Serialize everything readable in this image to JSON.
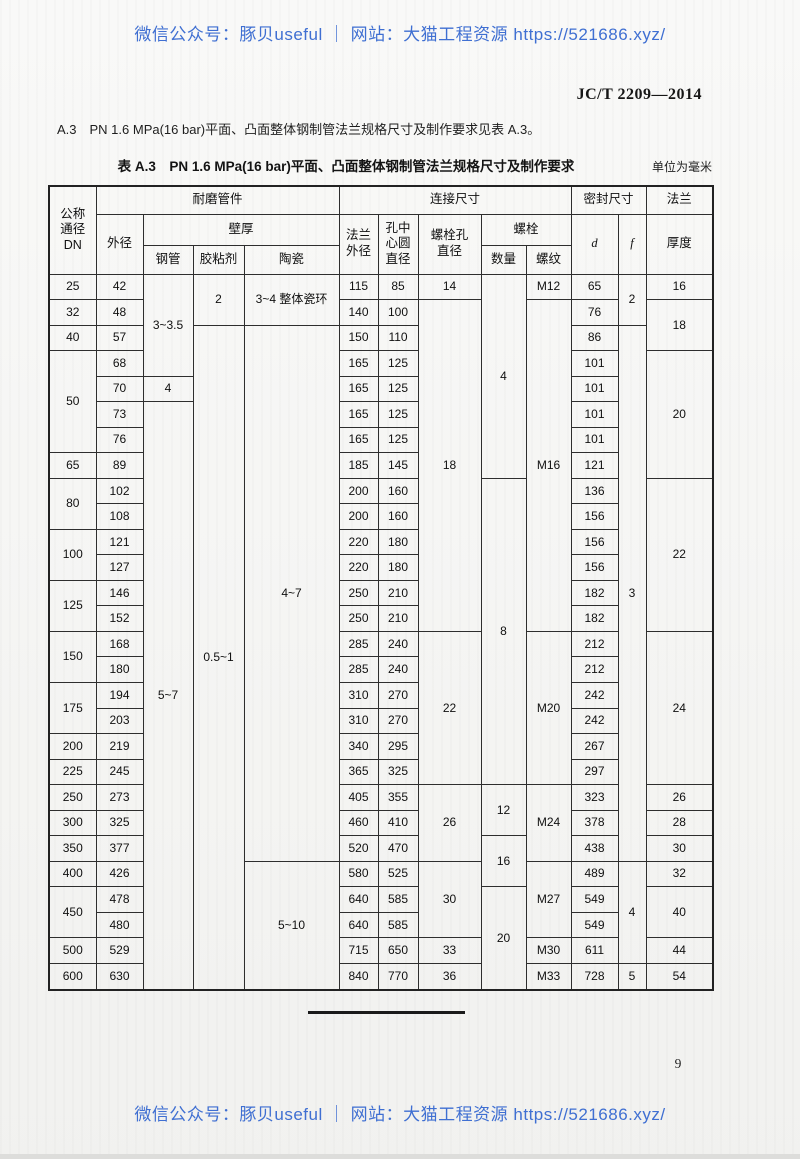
{
  "page": {
    "watermark_top": "微信公众号：豚贝useful ｜ 网站：大猫工程资源 https://521686.xyz/",
    "watermark_bottom": "微信公众号：豚贝useful ｜ 网站：大猫工程资源 https://521686.xyz/",
    "watermark_color": "#3f6fd2",
    "standard_code": "JC/T 2209—2014",
    "paragraph": "A.3　PN 1.6 MPa(16 bar)平面、凸面整体钢制管法兰规格尺寸及制作要求见表 A.3。",
    "page_number": "9"
  },
  "table": {
    "caption": "表 A.3　PN 1.6 MPa(16 bar)平面、凸面整体钢制管法兰规格尺寸及制作要求",
    "unit_note": "单位为毫米",
    "col_widths": [
      47,
      47,
      50,
      51,
      95,
      39,
      40,
      63,
      45,
      45,
      47,
      28,
      67
    ],
    "head_rows": [
      [
        {
          "t": "公称\n通径\nDN",
          "rs": 3
        },
        {
          "t": "耐磨管件",
          "cs": 4
        },
        {
          "t": "连接尺寸",
          "cs": 5
        },
        {
          "t": "密封尺寸",
          "cs": 2
        },
        {
          "t": "法兰"
        }
      ],
      [
        {
          "t": "外径",
          "rs": 2
        },
        {
          "t": "壁厚",
          "cs": 3
        },
        {
          "t": "法兰\n外径",
          "rs": 2
        },
        {
          "t": "孔中\n心圆\n直径",
          "rs": 2
        },
        {
          "t": "螺栓孔\n直径",
          "rs": 2
        },
        {
          "t": "螺栓",
          "cs": 2
        },
        {
          "t": "d",
          "rs": 2,
          "i": true
        },
        {
          "t": "f",
          "rs": 2,
          "i": true
        },
        {
          "t": "厚度",
          "rs": 2
        }
      ],
      [
        {
          "t": "钢管"
        },
        {
          "t": "胶粘剂"
        },
        {
          "t": "陶瓷"
        },
        {
          "t": "数量"
        },
        {
          "t": "螺纹"
        }
      ]
    ],
    "body_rows": [
      [
        {
          "t": "25"
        },
        {
          "t": "42"
        },
        {
          "t": "3~3.5",
          "rs": 4
        },
        {
          "t": "2",
          "rs": 2
        },
        {
          "t": "3~4 整体瓷环",
          "rs": 2
        },
        {
          "t": "115"
        },
        {
          "t": "85"
        },
        {
          "t": "14"
        },
        {
          "t": "4",
          "rs": 8
        },
        {
          "t": "M12"
        },
        {
          "t": "65"
        },
        {
          "t": "2",
          "rs": 2
        },
        {
          "t": "16"
        }
      ],
      [
        {
          "t": "32"
        },
        {
          "t": "48"
        },
        {
          "t": "140"
        },
        {
          "t": "100"
        },
        {
          "t": "18",
          "rs": 13
        },
        {
          "t": "M16",
          "rs": 13
        },
        {
          "t": "76"
        },
        {
          "t": "18",
          "rs": 2
        }
      ],
      [
        {
          "t": "40"
        },
        {
          "t": "57"
        },
        {
          "t": "0.5~1",
          "rs": 26
        },
        {
          "t": "4~7",
          "rs": 21
        },
        {
          "t": "150"
        },
        {
          "t": "110"
        },
        {
          "t": "86"
        },
        {
          "t": "3",
          "rs": 21
        }
      ],
      [
        {
          "t": "50",
          "rs": 4
        },
        {
          "t": "68"
        },
        {
          "t": "165"
        },
        {
          "t": "125"
        },
        {
          "t": "101"
        },
        {
          "t": "20",
          "rs": 5
        }
      ],
      [
        {
          "t": "70"
        },
        {
          "t": "4"
        },
        {
          "t": "165"
        },
        {
          "t": "125"
        },
        {
          "t": "101"
        }
      ],
      [
        {
          "t": "73"
        },
        {
          "t": "5~7",
          "rs": 23
        },
        {
          "t": "165"
        },
        {
          "t": "125"
        },
        {
          "t": "101"
        }
      ],
      [
        {
          "t": "76"
        },
        {
          "t": "165"
        },
        {
          "t": "125"
        },
        {
          "t": "101"
        }
      ],
      [
        {
          "t": "65"
        },
        {
          "t": "89"
        },
        {
          "t": "185"
        },
        {
          "t": "145"
        },
        {
          "t": "121"
        }
      ],
      [
        {
          "t": "80",
          "rs": 2
        },
        {
          "t": "102"
        },
        {
          "t": "200"
        },
        {
          "t": "160"
        },
        {
          "t": "8",
          "rs": 12
        },
        {
          "t": "136"
        },
        {
          "t": "22",
          "rs": 6
        }
      ],
      [
        {
          "t": "108"
        },
        {
          "t": "200"
        },
        {
          "t": "160"
        },
        {
          "t": "156"
        }
      ],
      [
        {
          "t": "100",
          "rs": 2
        },
        {
          "t": "121"
        },
        {
          "t": "220"
        },
        {
          "t": "180"
        },
        {
          "t": "156"
        }
      ],
      [
        {
          "t": "127"
        },
        {
          "t": "220"
        },
        {
          "t": "180"
        },
        {
          "t": "156"
        }
      ],
      [
        {
          "t": "125",
          "rs": 2
        },
        {
          "t": "146"
        },
        {
          "t": "250"
        },
        {
          "t": "210"
        },
        {
          "t": "182"
        }
      ],
      [
        {
          "t": "152"
        },
        {
          "t": "250"
        },
        {
          "t": "210"
        },
        {
          "t": "182"
        }
      ],
      [
        {
          "t": "150",
          "rs": 2
        },
        {
          "t": "168"
        },
        {
          "t": "285"
        },
        {
          "t": "240"
        },
        {
          "t": "22",
          "rs": 6
        },
        {
          "t": "M20",
          "rs": 6
        },
        {
          "t": "212"
        },
        {
          "t": "24",
          "rs": 6
        }
      ],
      [
        {
          "t": "180"
        },
        {
          "t": "285"
        },
        {
          "t": "240"
        },
        {
          "t": "212"
        }
      ],
      [
        {
          "t": "175",
          "rs": 2
        },
        {
          "t": "194"
        },
        {
          "t": "310"
        },
        {
          "t": "270"
        },
        {
          "t": "242"
        }
      ],
      [
        {
          "t": "203"
        },
        {
          "t": "310"
        },
        {
          "t": "270"
        },
        {
          "t": "242"
        }
      ],
      [
        {
          "t": "200"
        },
        {
          "t": "219"
        },
        {
          "t": "340"
        },
        {
          "t": "295"
        },
        {
          "t": "267"
        }
      ],
      [
        {
          "t": "225"
        },
        {
          "t": "245"
        },
        {
          "t": "365"
        },
        {
          "t": "325"
        },
        {
          "t": "297"
        }
      ],
      [
        {
          "t": "250"
        },
        {
          "t": "273"
        },
        {
          "t": "405"
        },
        {
          "t": "355"
        },
        {
          "t": "26",
          "rs": 3
        },
        {
          "t": "12",
          "rs": 2
        },
        {
          "t": "M24",
          "rs": 3
        },
        {
          "t": "323"
        },
        {
          "t": "26"
        }
      ],
      [
        {
          "t": "300"
        },
        {
          "t": "325"
        },
        {
          "t": "460"
        },
        {
          "t": "410"
        },
        {
          "t": "378"
        },
        {
          "t": "28"
        }
      ],
      [
        {
          "t": "350"
        },
        {
          "t": "377"
        },
        {
          "t": "520"
        },
        {
          "t": "470"
        },
        {
          "t": "16",
          "rs": 2
        },
        {
          "t": "438"
        },
        {
          "t": "30"
        }
      ],
      [
        {
          "t": "400"
        },
        {
          "t": "426"
        },
        {
          "t": "5~10",
          "rs": 5
        },
        {
          "t": "580"
        },
        {
          "t": "525"
        },
        {
          "t": "30",
          "rs": 3
        },
        {
          "t": "M27",
          "rs": 3
        },
        {
          "t": "489"
        },
        {
          "t": "4",
          "rs": 4
        },
        {
          "t": "32"
        }
      ],
      [
        {
          "t": "450",
          "rs": 2
        },
        {
          "t": "478"
        },
        {
          "t": "640"
        },
        {
          "t": "585"
        },
        {
          "t": "20",
          "rs": 4
        },
        {
          "t": "549"
        },
        {
          "t": "40",
          "rs": 2
        }
      ],
      [
        {
          "t": "480"
        },
        {
          "t": "640"
        },
        {
          "t": "585"
        },
        {
          "t": "549"
        }
      ],
      [
        {
          "t": "500"
        },
        {
          "t": "529"
        },
        {
          "t": "715"
        },
        {
          "t": "650"
        },
        {
          "t": "33"
        },
        {
          "t": "M30"
        },
        {
          "t": "611"
        },
        {
          "t": "44"
        }
      ],
      [
        {
          "t": "600"
        },
        {
          "t": "630"
        },
        {
          "t": "840"
        },
        {
          "t": "770"
        },
        {
          "t": "36"
        },
        {
          "t": "M33"
        },
        {
          "t": "728"
        },
        {
          "t": "5"
        },
        {
          "t": "54"
        }
      ]
    ]
  }
}
